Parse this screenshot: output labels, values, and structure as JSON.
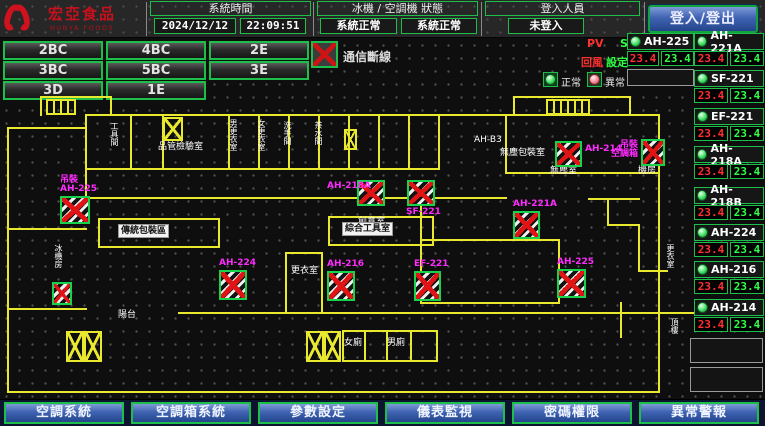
{
  "colors": {
    "accent_green": "#1dbf4a",
    "magenta": "#ff2bff",
    "alarm_red": "#e01414",
    "pv_red": "#ff3030",
    "sv_green": "#30ff45",
    "wall_yellow": "#e8e82e",
    "button_blue": "#3f63b2"
  },
  "header": {
    "brand": "宏亞食品",
    "brand_en": "HUNYA FOODS",
    "system_time": {
      "label": "系統時間",
      "date": "2024/12/12",
      "time": "22:09:51"
    },
    "machine_status": {
      "label": "冰機 / 空調機 狀態",
      "chiller": "系統正常",
      "ahu": "系統正常"
    },
    "login": {
      "label": "登入人員",
      "value": "未登入",
      "button": "登入/登出"
    }
  },
  "floor_nav": {
    "rows": [
      [
        "2BC",
        "4BC",
        "2E"
      ],
      [
        "3BC",
        "5BC",
        "3E"
      ],
      [
        "3D",
        "1E"
      ]
    ]
  },
  "comm_alarm": {
    "label": "通信斷線"
  },
  "monitor_legend": {
    "pv": "PV",
    "sv": "SV",
    "pv_name": "回風",
    "sv_name": "設定",
    "normal": "正常",
    "abnormal": "異常"
  },
  "equipment_panel": {
    "left_column": [
      {
        "name": "AH-225",
        "pv": "23.4",
        "sv": "23.4",
        "y": 33
      }
    ],
    "right_column": [
      {
        "name": "AH-221A",
        "pv": "23.4",
        "sv": "23.4",
        "y": 33
      },
      {
        "name": "SF-221",
        "pv": "23.4",
        "sv": "23.4",
        "y": 70
      },
      {
        "name": "EF-221",
        "pv": "23.4",
        "sv": "23.4",
        "y": 108
      },
      {
        "name": "AH-218A",
        "pv": "23.4",
        "sv": "23.4",
        "y": 146
      },
      {
        "name": "AH-218B",
        "pv": "23.4",
        "sv": "23.4",
        "y": 187
      },
      {
        "name": "AH-224",
        "pv": "23.4",
        "sv": "23.4",
        "y": 224
      },
      {
        "name": "AH-216",
        "pv": "23.4",
        "sv": "23.4",
        "y": 261
      },
      {
        "name": "AH-214",
        "pv": "23.4",
        "sv": "23.4",
        "y": 299
      }
    ]
  },
  "map": {
    "equipment_boxes": [
      {
        "label": [
          "吊裝",
          "AH-225"
        ],
        "lp": "above",
        "x": 60,
        "y": 196,
        "w": 30,
        "h": 28
      },
      {
        "label": [],
        "lp": "none",
        "x": 52,
        "y": 282,
        "w": 20,
        "h": 23
      },
      {
        "label": [
          "AH-224"
        ],
        "lp": "above",
        "x": 219,
        "y": 270,
        "w": 28,
        "h": 30
      },
      {
        "label": [
          "AH-218A"
        ],
        "lp": "left",
        "x": 357,
        "y": 180,
        "w": 28,
        "h": 26
      },
      {
        "label": [
          "SF-221"
        ],
        "lp": "below",
        "x": 407,
        "y": 180,
        "w": 28,
        "h": 26
      },
      {
        "label": [
          "AH-214"
        ],
        "lp": "right",
        "x": 555,
        "y": 141,
        "w": 27,
        "h": 26
      },
      {
        "label": [
          "吊裝",
          "空調箱"
        ],
        "lp": "left",
        "x": 641,
        "y": 139,
        "w": 24,
        "h": 27
      },
      {
        "label": [
          "AH-221A"
        ],
        "lp": "above",
        "x": 513,
        "y": 211,
        "w": 27,
        "h": 28
      },
      {
        "label": [
          "AH-216"
        ],
        "lp": "above",
        "x": 327,
        "y": 271,
        "w": 28,
        "h": 30
      },
      {
        "label": [
          "EF-221"
        ],
        "lp": "above",
        "x": 414,
        "y": 271,
        "w": 27,
        "h": 30
      },
      {
        "label": [
          "AH-225"
        ],
        "lp": "above",
        "x": 557,
        "y": 269,
        "w": 29,
        "h": 29
      }
    ],
    "room_labels": [
      {
        "t": "工具間",
        "x": 110,
        "y": 122,
        "v": 1
      },
      {
        "t": "品管檢驗室",
        "x": 158,
        "y": 142
      },
      {
        "t": "男更衣室",
        "x": 229,
        "y": 119,
        "v": 1
      },
      {
        "t": "女更衣室",
        "x": 257,
        "y": 119,
        "v": 1
      },
      {
        "t": "洗手間",
        "x": 283,
        "y": 121,
        "v": 1
      },
      {
        "t": "茶水間",
        "x": 314,
        "y": 121,
        "v": 1
      },
      {
        "t": "AH-B3",
        "x": 474,
        "y": 135
      },
      {
        "t": "無塵包裝室",
        "x": 500,
        "y": 148
      },
      {
        "t": "無塵室",
        "x": 550,
        "y": 166
      },
      {
        "t": "機房",
        "x": 638,
        "y": 166
      },
      {
        "t": "創意室",
        "x": 358,
        "y": 217
      },
      {
        "t": "更衣室",
        "x": 291,
        "y": 266
      },
      {
        "t": "冰機房",
        "x": 54,
        "y": 244,
        "v": 1
      },
      {
        "t": "陽台",
        "x": 118,
        "y": 310
      },
      {
        "t": "女廁",
        "x": 344,
        "y": 338
      },
      {
        "t": "男廁",
        "x": 387,
        "y": 338
      },
      {
        "t": "更衣室",
        "x": 666,
        "y": 244,
        "v": 1
      },
      {
        "t": "頂樓",
        "x": 670,
        "y": 318,
        "v": 1
      }
    ],
    "whitebg_labels": [
      {
        "t": "傳統包裝區",
        "x": 118,
        "y": 224
      },
      {
        "t": "綜合工具室",
        "x": 342,
        "y": 222
      }
    ]
  },
  "footer": {
    "buttons": [
      "空調系統",
      "空調箱系統",
      "參數設定",
      "儀表監視",
      "密碼權限",
      "異常警報"
    ]
  }
}
